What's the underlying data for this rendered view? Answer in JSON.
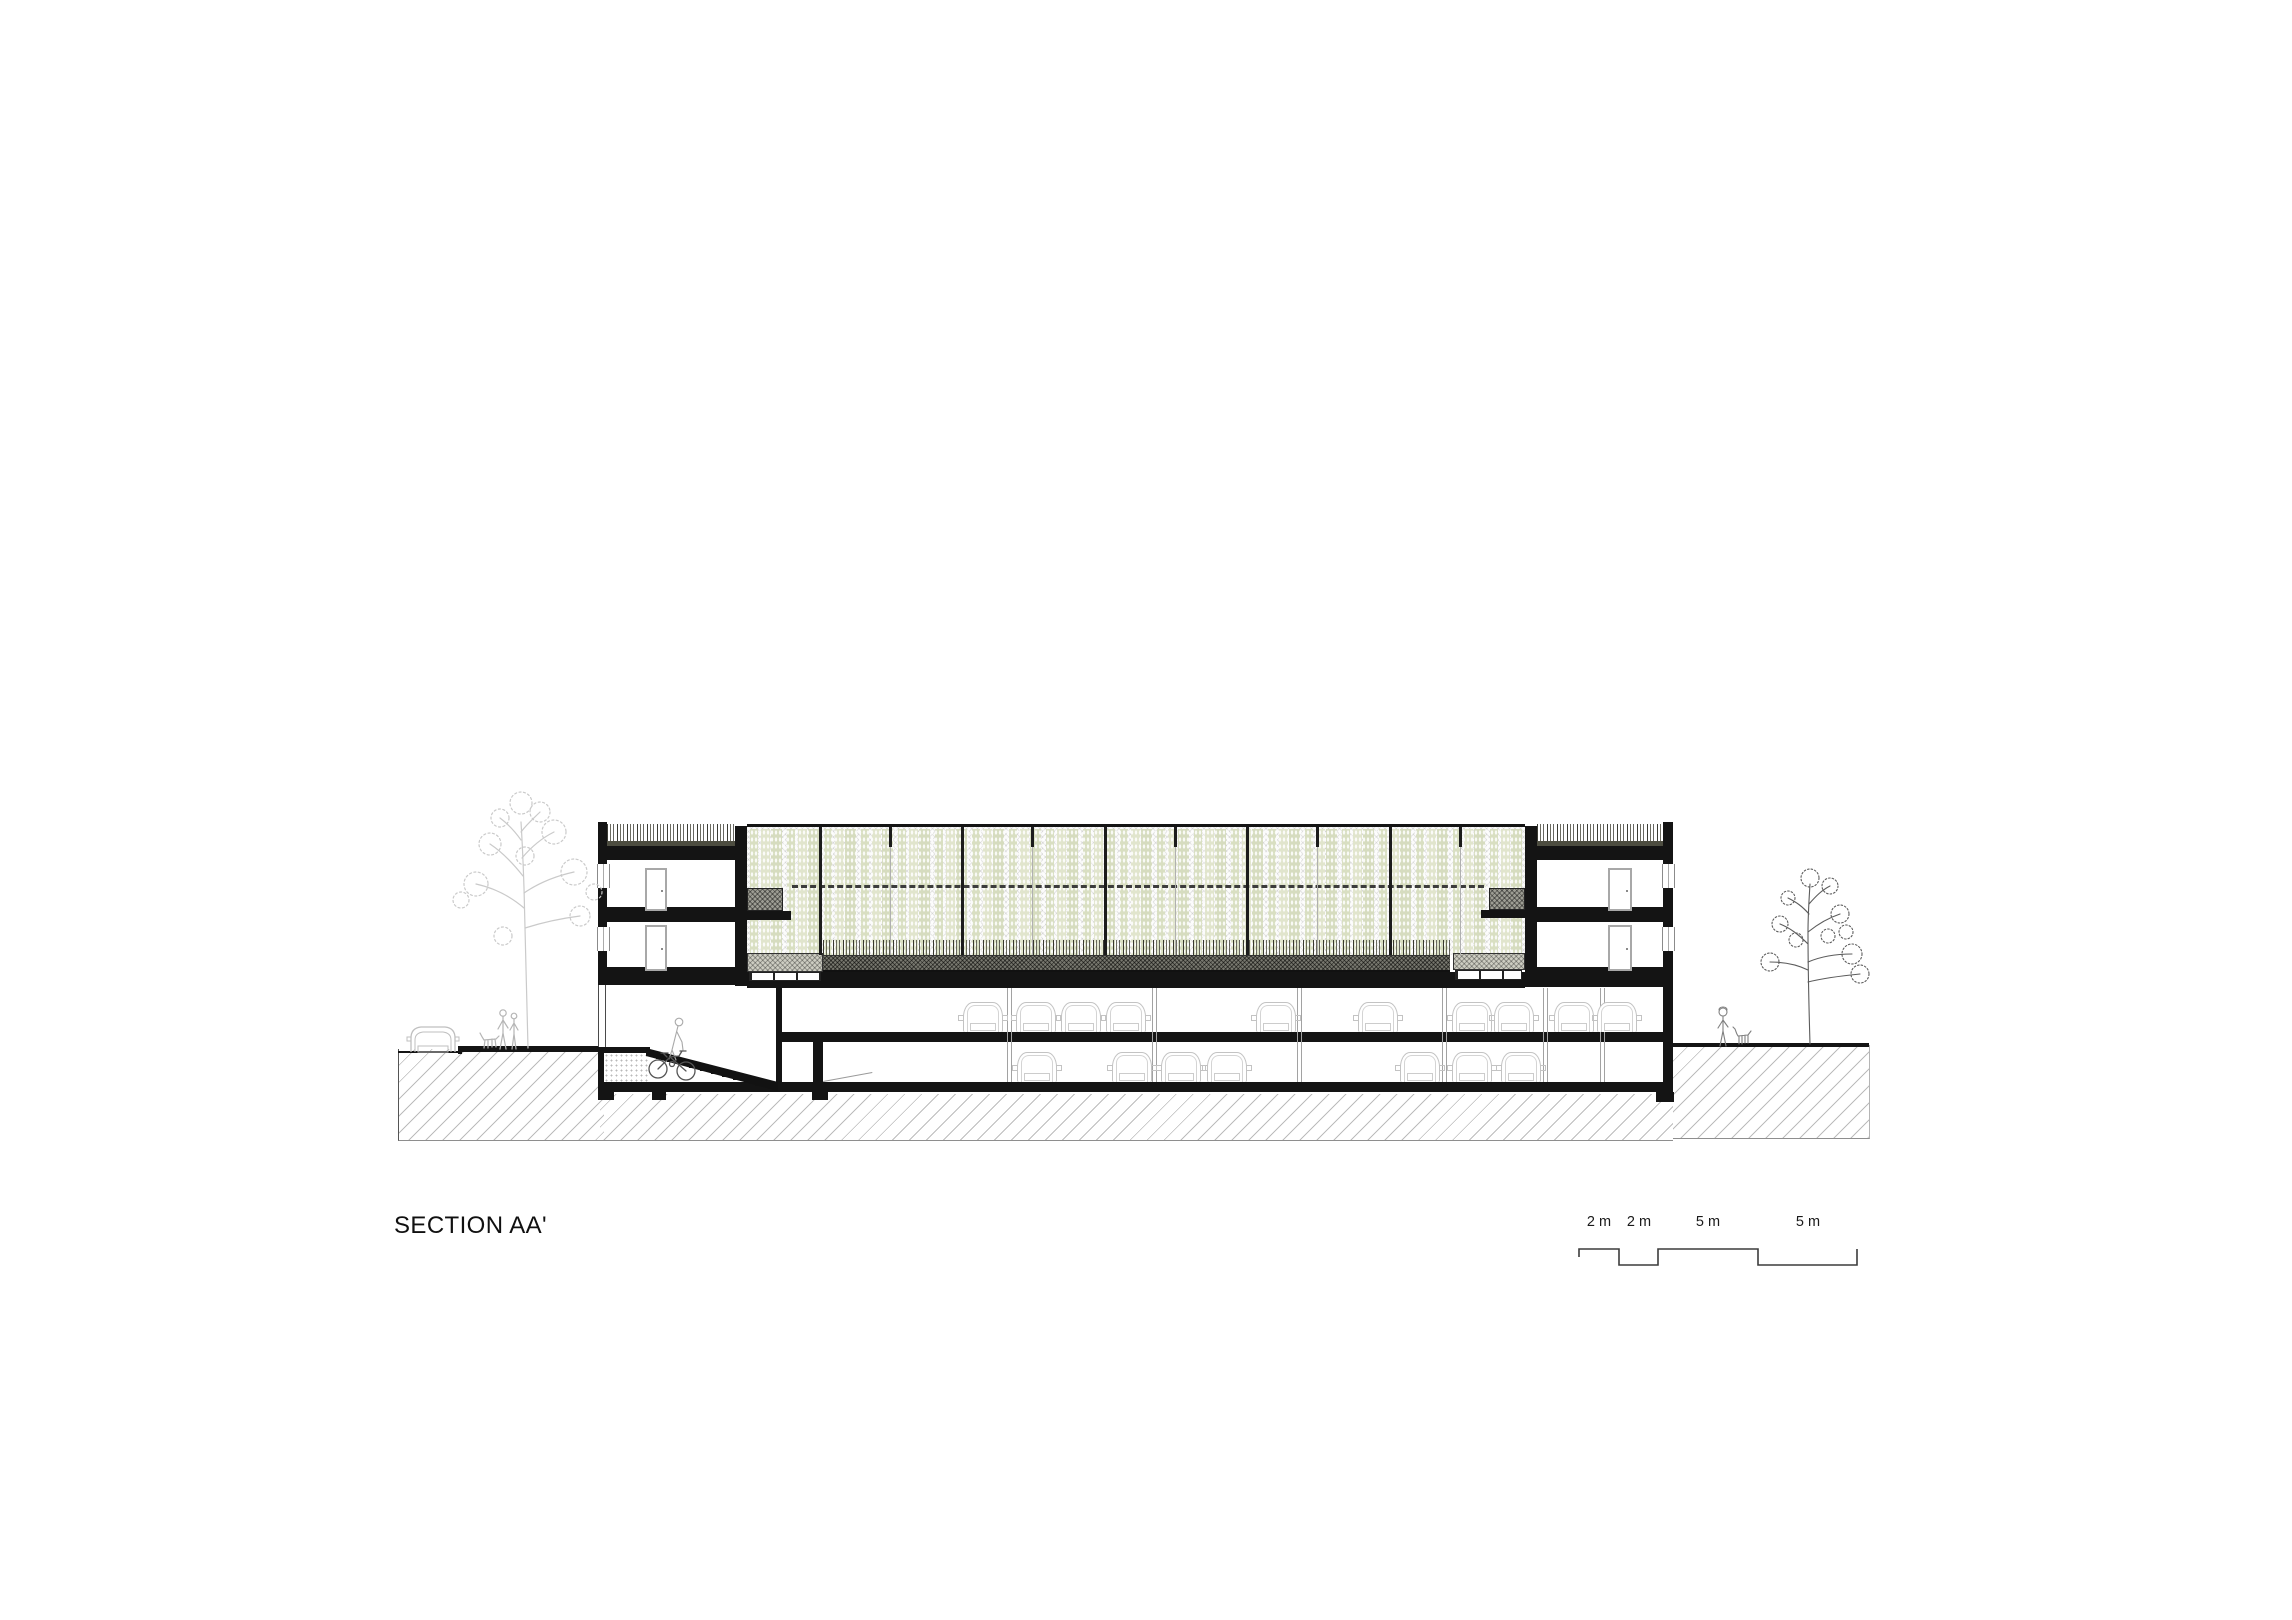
{
  "meta": {
    "title": "SECTION AA'",
    "drawing_type": "architectural cross section"
  },
  "scale_bar": {
    "labels": [
      "2 m",
      "2 m",
      "5 m",
      "5 m"
    ]
  },
  "colors": {
    "ink": "#141414",
    "plant_green": "#dce1c6",
    "plant_green_alt": "#e1e5cd",
    "soil_gray": "#78786f",
    "planter_gray": "#9d9d93",
    "planter_light": "#cdcdc2",
    "roof_soil": "#4d4d40",
    "hatch_line": "#bcbcbc",
    "sketch_light": "#c9c9c9",
    "sketch_dark": "#5c5c5c",
    "car_outline": "#c3c3c3"
  },
  "drawing": {
    "greenhouse": {
      "mullions_x": [
        819,
        961,
        1104,
        1246,
        1389
      ],
      "stub_mullions_x": [
        889,
        1031,
        1174,
        1316,
        1459
      ]
    },
    "parking": {
      "columns_x": [
        1007,
        1152,
        1297,
        1442,
        1543,
        1600
      ],
      "cars_level1_x": [
        963,
        1016,
        1061,
        1106,
        1256,
        1358,
        1452,
        1494,
        1554,
        1597
      ],
      "cars_level2_x": [
        1017,
        1112,
        1161,
        1207,
        1400,
        1452,
        1501
      ],
      "footings": [
        [
          598,
          1090,
          16
        ],
        [
          652,
          1090,
          14
        ],
        [
          812,
          1090,
          16
        ],
        [
          1656,
          1092,
          18
        ]
      ],
      "levels": 2
    },
    "entities": {
      "trees": 2,
      "pedestrians_left": 2,
      "pedestrians_right": 1,
      "dogs": 2,
      "bicycles": 1,
      "street_cars": 1
    }
  }
}
